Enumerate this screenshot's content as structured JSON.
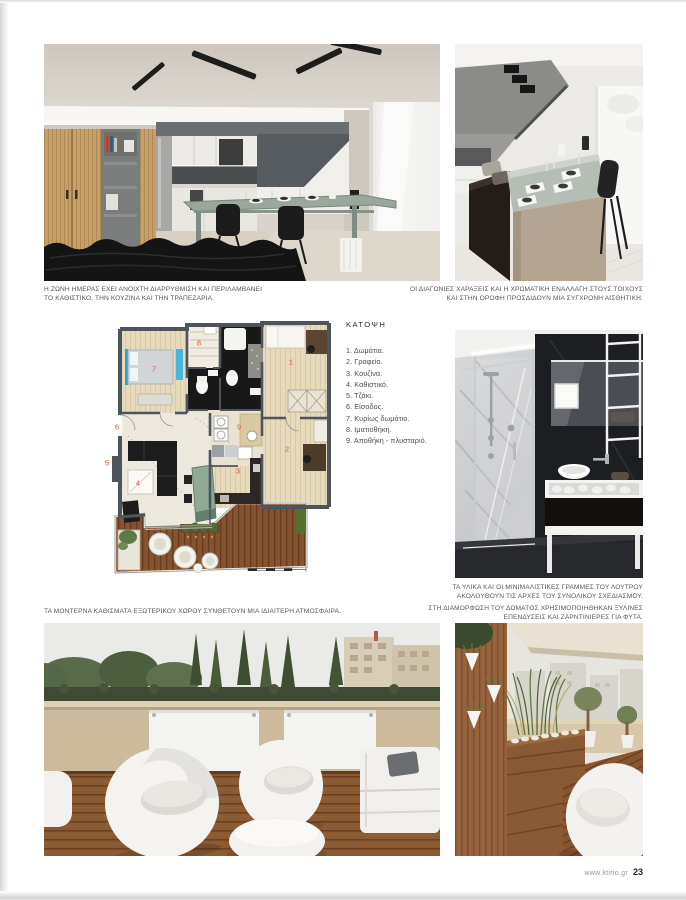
{
  "page": {
    "site_url": "www.ktirio.gr",
    "page_number": "23"
  },
  "captions": {
    "living": [
      "Η ΖΩΝΗ ΗΜΕΡΑΣ ΕΧΕΙ ΑΝΟΙΧΤΗ ΔΙΑΡΡΥΘΜΙΣΗ ΚΑΙ ΠΕΡΙΛΑΜΒΑΝΕΙ",
      "ΤΟ ΚΑΘΙΣΤΙΚΟ, ΤΗΝ ΚΟΥΖΙΝΑ ΚΑΙ ΤΗΝ ΤΡΑΠΕΖΑΡΙΑ."
    ],
    "dining": [
      "ΟΙ ΔΙΑΓΩΝΙΕΣ ΧΑΡΑΞΕΙΣ ΚΑΙ Η ΧΡΩΜΑΤΙΚΗ ΕΝΑΛΛΑΓΗ ΣΤΟΥΣ ΤΟΙΧΟΥΣ",
      "ΚΑΙ ΣΤΗΝ ΟΡΟΦΗ ΠΡΟΣΔΙΔΟΥΝ ΜΙΑ ΣΥΓΧΡΟΝΗ ΑΙΣΘΗΤΙΚΗ."
    ],
    "bathroom": [
      "ΤΑ ΥΛΙΚΑ ΚΑΙ ΟΙ ΜΙΝΙΜΑΛΙΣΤΙΚΕΣ ΓΡΑΜΜΕΣ ΤΟΥ ΛΟΥΤΡΟΥ",
      "ΑΚΟΛΟΥΘΟΥΝ ΤΙΣ ΑΡΧΕΣ ΤΟΥ ΣΥΝΟΛΙΚΟΥ ΣΧΕΔΙΑΣΜΟΥ."
    ],
    "roof_room": [
      "ΣΤΗ ΔΙΑΜΟΡΦΩΣΗ ΤΟΥ ΔΩΜΑΤΟΣ ΧΡΗΣΙΜΟΠΟΙΗΘΗΚΑΝ ΞΥΛΙΝΕΣ",
      "ΕΠΕΝΔΥΣΕΙΣ ΚΑΙ ΖΑΡΝΤΙΝΙΕΡΕΣ ΓΙΑ ΦΥΤΑ."
    ],
    "terrace": [
      "ΤΑ ΜΟΝΤΕΡΝΑ ΚΑΘΙΣΜΑΤΑ ΕΞΩΤΕΡΙΚΟΥ ΧΩΡΟΥ ΣΥΝΘΕΤΟΥΝ ΜΙΑ ΙΔΙΑΙΤΕΡΗ ΑΤΜΟΣΦΑΙΡΑ."
    ]
  },
  "floorplan": {
    "title": "ΚΑΤΟΨΗ",
    "legend": [
      {
        "num": "1.",
        "label": "Δωμάτια."
      },
      {
        "num": "2.",
        "label": "Γραφείο."
      },
      {
        "num": "3.",
        "label": "Κουζίνα."
      },
      {
        "num": "4.",
        "label": "Καθιστικό."
      },
      {
        "num": "5.",
        "label": "Τζάκι."
      },
      {
        "num": "6.",
        "label": "Είσοδος."
      },
      {
        "num": "7.",
        "label": "Κυρίως δωμάτιο."
      },
      {
        "num": "8.",
        "label": "Ιματιοθήκη."
      },
      {
        "num": "9.",
        "label": "Αποθήκη - πλυσταριό."
      }
    ],
    "plan_labels": [
      {
        "n": "1",
        "x": 191,
        "y": 44
      },
      {
        "n": "2",
        "x": 187,
        "y": 131
      },
      {
        "n": "3",
        "x": 138,
        "y": 153
      },
      {
        "n": "4",
        "x": 38,
        "y": 165
      },
      {
        "n": "5",
        "x": 7,
        "y": 145
      },
      {
        "n": "6",
        "x": 17,
        "y": 109
      },
      {
        "n": "7",
        "x": 54,
        "y": 51
      },
      {
        "n": "8",
        "x": 99,
        "y": 25
      },
      {
        "n": "9",
        "x": 139,
        "y": 109
      }
    ],
    "label_color": "#ee4d2e",
    "accent_blue": "#2aa4d4",
    "deck_wood": "#86522f"
  }
}
